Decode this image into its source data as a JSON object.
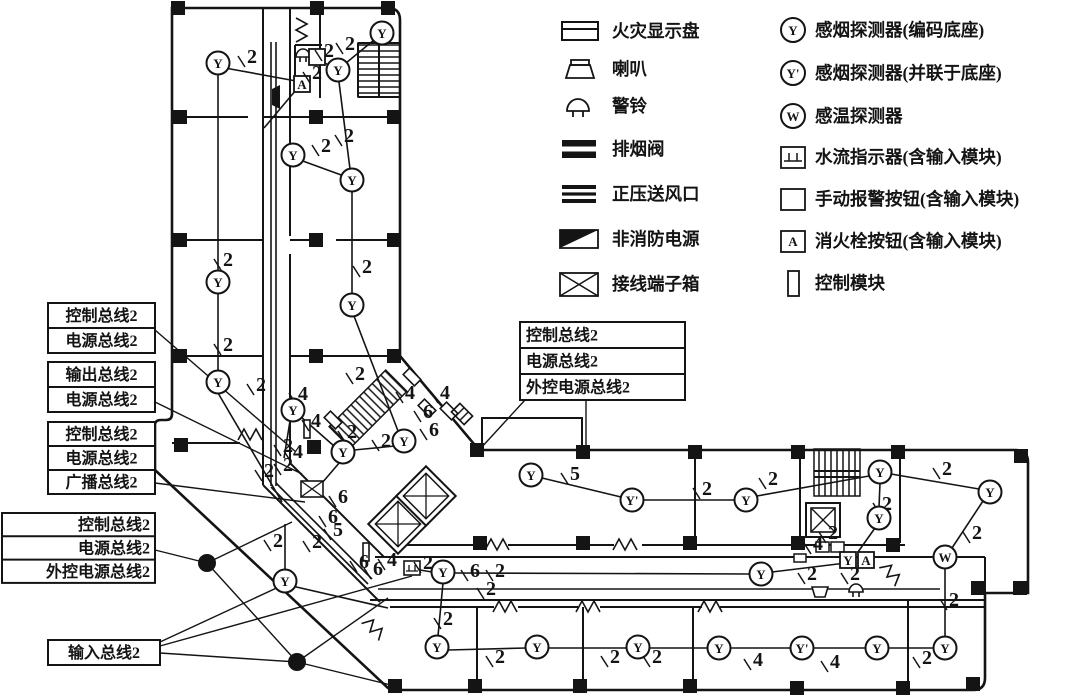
{
  "colors": {
    "ink": "#141414",
    "bg": "#ffffff"
  },
  "legend": {
    "left": [
      {
        "icon": "fire-display-panel-icon",
        "label": "火灾显示盘"
      },
      {
        "icon": "speaker-icon",
        "label": "喇叭"
      },
      {
        "icon": "alarm-bell-icon",
        "label": "警铃"
      },
      {
        "icon": "smoke-exhaust-valve-icon",
        "label": "排烟阀"
      },
      {
        "icon": "pressurized-air-outlet-icon",
        "label": "正压送风口"
      },
      {
        "icon": "non-fire-power-icon",
        "label": "非消防电源"
      },
      {
        "icon": "terminal-box-icon",
        "label": "接线端子箱"
      }
    ],
    "right": [
      {
        "icon": "smoke-detector-icon",
        "symbol": "Y",
        "label": "感烟探测器(编码底座)"
      },
      {
        "icon": "smoke-detector-parallel-icon",
        "symbol": "Y'",
        "label": "感烟探测器(并联于底座)"
      },
      {
        "icon": "heat-detector-icon",
        "symbol": "W",
        "label": "感温探测器"
      },
      {
        "icon": "water-flow-indicator-icon",
        "symbol": "",
        "label": "水流指示器(含输入模块)"
      },
      {
        "icon": "manual-alarm-button-icon",
        "symbol": "",
        "label": "手动报警按钮(含输入模块)"
      },
      {
        "icon": "hydrant-button-icon",
        "symbol": "A",
        "label": "消火栓按钮(含输入模块)"
      },
      {
        "icon": "control-module-icon",
        "symbol": "",
        "label": "控制模块"
      }
    ]
  },
  "callouts": {
    "left_groups": [
      {
        "x": 48,
        "y": 303,
        "w": 107,
        "rh": 25,
        "align": "middle",
        "rows": [
          "控制总线2",
          "电源总线2"
        ]
      },
      {
        "x": 48,
        "y": 362,
        "w": 107,
        "rh": 25,
        "align": "middle",
        "rows": [
          "输出总线2",
          "电源总线2"
        ]
      },
      {
        "x": 48,
        "y": 422,
        "w": 107,
        "rh": 24,
        "align": "middle",
        "rows": [
          "控制总线2",
          "电源总线2",
          "广播总线2"
        ]
      },
      {
        "x": 2,
        "y": 513,
        "w": 153,
        "rh": 23.3,
        "align": "end",
        "rows": [
          "控制总线2",
          "电源总线2",
          "外控电源总线2"
        ]
      },
      {
        "x": 48,
        "y": 640,
        "w": 112,
        "rh": 25,
        "align": "middle",
        "rows": [
          "输入总线2"
        ]
      }
    ],
    "middle_box": {
      "x": 520,
      "y": 322,
      "w": 165,
      "rh": 26,
      "align": "start",
      "rows": [
        "控制总线2",
        "电源总线2",
        "外控电源总线2"
      ]
    }
  },
  "plan": {
    "detectors": [
      {
        "t": "Y",
        "x": 218,
        "y": 63
      },
      {
        "t": "Y",
        "x": 338,
        "y": 70
      },
      {
        "t": "Y",
        "x": 382,
        "y": 33
      },
      {
        "t": "Y",
        "x": 293,
        "y": 155
      },
      {
        "t": "Y",
        "x": 352,
        "y": 180
      },
      {
        "t": "Y",
        "x": 218,
        "y": 282
      },
      {
        "t": "Y",
        "x": 218,
        "y": 382
      },
      {
        "t": "Y",
        "x": 352,
        "y": 305
      },
      {
        "t": "Y",
        "x": 293,
        "y": 410
      },
      {
        "t": "Y",
        "x": 343,
        "y": 452
      },
      {
        "t": "Y",
        "x": 404,
        "y": 441
      },
      {
        "t": "Y",
        "x": 285,
        "y": 581
      },
      {
        "t": "Y",
        "x": 443,
        "y": 572
      },
      {
        "t": "Y",
        "x": 761,
        "y": 574
      },
      {
        "t": "Y",
        "x": 437,
        "y": 647
      },
      {
        "t": "Y",
        "x": 537,
        "y": 647
      },
      {
        "t": "Y",
        "x": 638,
        "y": 647
      },
      {
        "t": "Y",
        "x": 719,
        "y": 648
      },
      {
        "t": "Y'",
        "x": 802,
        "y": 648
      },
      {
        "t": "Y",
        "x": 877,
        "y": 648
      },
      {
        "t": "Y",
        "x": 945,
        "y": 648
      },
      {
        "t": "Y",
        "x": 531,
        "y": 475
      },
      {
        "t": "Y'",
        "x": 632,
        "y": 500
      },
      {
        "t": "Y",
        "x": 746,
        "y": 500
      },
      {
        "t": "Y",
        "x": 880,
        "y": 472
      },
      {
        "t": "Y",
        "x": 879,
        "y": 518
      },
      {
        "t": "Y",
        "x": 990,
        "y": 492
      },
      {
        "t": "W",
        "x": 945,
        "y": 557
      }
    ],
    "wire_labels": [
      {
        "n": "2",
        "x": 252,
        "y": 57
      },
      {
        "n": "2",
        "x": 329,
        "y": 51
      },
      {
        "n": "2",
        "x": 350,
        "y": 44
      },
      {
        "n": "2",
        "x": 317,
        "y": 73
      },
      {
        "n": "2",
        "x": 326,
        "y": 146
      },
      {
        "n": "2",
        "x": 349,
        "y": 136
      },
      {
        "n": "2",
        "x": 228,
        "y": 260
      },
      {
        "n": "2",
        "x": 367,
        "y": 267
      },
      {
        "n": "2",
        "x": 228,
        "y": 345
      },
      {
        "n": "2",
        "x": 360,
        "y": 374
      },
      {
        "n": "2",
        "x": 261,
        "y": 385
      },
      {
        "n": "4",
        "x": 303,
        "y": 394
      },
      {
        "n": "4",
        "x": 316,
        "y": 421
      },
      {
        "n": "2",
        "x": 288,
        "y": 446
      },
      {
        "n": "4",
        "x": 298,
        "y": 452
      },
      {
        "n": "2",
        "x": 288,
        "y": 465
      },
      {
        "n": "2",
        "x": 269,
        "y": 471
      },
      {
        "n": "2",
        "x": 352,
        "y": 432
      },
      {
        "n": "2",
        "x": 386,
        "y": 441
      },
      {
        "n": "4",
        "x": 410,
        "y": 393
      },
      {
        "n": "4",
        "x": 445,
        "y": 393
      },
      {
        "n": "6",
        "x": 428,
        "y": 412
      },
      {
        "n": "6",
        "x": 434,
        "y": 430
      },
      {
        "n": "6",
        "x": 343,
        "y": 497
      },
      {
        "n": "6",
        "x": 333,
        "y": 517
      },
      {
        "n": "5",
        "x": 338,
        "y": 530
      },
      {
        "n": "2",
        "x": 278,
        "y": 541
      },
      {
        "n": "2",
        "x": 317,
        "y": 542
      },
      {
        "n": "6",
        "x": 364,
        "y": 562
      },
      {
        "n": "6",
        "x": 378,
        "y": 569
      },
      {
        "n": "4",
        "x": 392,
        "y": 560
      },
      {
        "n": "2",
        "x": 428,
        "y": 563
      },
      {
        "n": "6",
        "x": 475,
        "y": 571
      },
      {
        "n": "2",
        "x": 500,
        "y": 571
      },
      {
        "n": "2",
        "x": 491,
        "y": 589
      },
      {
        "n": "2",
        "x": 448,
        "y": 619
      },
      {
        "n": "5",
        "x": 575,
        "y": 474
      },
      {
        "n": "2",
        "x": 707,
        "y": 489
      },
      {
        "n": "2",
        "x": 773,
        "y": 479
      },
      {
        "n": "2",
        "x": 947,
        "y": 469
      },
      {
        "n": "2",
        "x": 887,
        "y": 504
      },
      {
        "n": "2",
        "x": 977,
        "y": 533
      },
      {
        "n": "2",
        "x": 954,
        "y": 600
      },
      {
        "n": "4",
        "x": 818,
        "y": 544
      },
      {
        "n": "2",
        "x": 833,
        "y": 533
      },
      {
        "n": "2",
        "x": 812,
        "y": 574
      },
      {
        "n": "2",
        "x": 855,
        "y": 574
      },
      {
        "n": "2",
        "x": 500,
        "y": 657
      },
      {
        "n": "2",
        "x": 615,
        "y": 657
      },
      {
        "n": "2",
        "x": 657,
        "y": 657
      },
      {
        "n": "4",
        "x": 758,
        "y": 660
      },
      {
        "n": "4",
        "x": 835,
        "y": 662
      },
      {
        "n": "2",
        "x": 927,
        "y": 658
      }
    ],
    "edges": [
      [
        225,
        68,
        296,
        81
      ],
      [
        218,
        74,
        218,
        271
      ],
      [
        218,
        293,
        218,
        371
      ],
      [
        218,
        393,
        282,
        502
      ],
      [
        374,
        40,
        346,
        63
      ],
      [
        330,
        66,
        320,
        60
      ],
      [
        296,
        90,
        264,
        128
      ],
      [
        300,
        160,
        344,
        176
      ],
      [
        350,
        169,
        339,
        82
      ],
      [
        352,
        191,
        352,
        294
      ],
      [
        354,
        316,
        398,
        431
      ],
      [
        395,
        446,
        354,
        450
      ],
      [
        334,
        446,
        301,
        417
      ],
      [
        290,
        421,
        284,
        458
      ],
      [
        340,
        462,
        322,
        483
      ],
      [
        285,
        570,
        285,
        524
      ],
      [
        292,
        586,
        388,
        608
      ],
      [
        271,
        42,
        271,
        486
      ],
      [
        276,
        42,
        276,
        486
      ],
      [
        271,
        487,
        368,
        584
      ],
      [
        276,
        483,
        372,
        579
      ],
      [
        420,
        570,
        432,
        572
      ],
      [
        454,
        573,
        750,
        574
      ],
      [
        772,
        572,
        846,
        563
      ],
      [
        378,
        589,
        940,
        589
      ],
      [
        443,
        583,
        438,
        636
      ],
      [
        448,
        650,
        526,
        648
      ],
      [
        548,
        648,
        627,
        648
      ],
      [
        649,
        648,
        708,
        648
      ],
      [
        730,
        648,
        791,
        648
      ],
      [
        813,
        648,
        866,
        648
      ],
      [
        888,
        648,
        934,
        648
      ],
      [
        542,
        478,
        621,
        497
      ],
      [
        643,
        500,
        735,
        500
      ],
      [
        757,
        496,
        869,
        476
      ],
      [
        891,
        474,
        979,
        489
      ],
      [
        880,
        483,
        879,
        507
      ],
      [
        875,
        528,
        858,
        552
      ],
      [
        983,
        501,
        952,
        548
      ],
      [
        945,
        568,
        945,
        637
      ]
    ],
    "leaders": [
      [
        155,
        330,
        296,
        452
      ],
      [
        155,
        402,
        302,
        474
      ],
      [
        155,
        483,
        305,
        502
      ],
      [
        155,
        550,
        207,
        563
      ],
      [
        207,
        563,
        292,
        522
      ],
      [
        207,
        563,
        297,
        662
      ],
      [
        160,
        642,
        283,
        585
      ],
      [
        160,
        646,
        412,
        576
      ],
      [
        160,
        653,
        297,
        662
      ],
      [
        297,
        662,
        388,
        598
      ],
      [
        297,
        662,
        395,
        686
      ],
      [
        525,
        400,
        480,
        449
      ],
      [
        586,
        400,
        586,
        450
      ]
    ],
    "columns": [
      [
        178,
        8
      ],
      [
        317,
        8
      ],
      [
        388,
        8
      ],
      [
        180,
        117
      ],
      [
        316,
        117
      ],
      [
        394,
        117
      ],
      [
        180,
        240
      ],
      [
        316,
        240
      ],
      [
        394,
        240
      ],
      [
        180,
        356
      ],
      [
        316,
        356
      ],
      [
        394,
        356
      ],
      [
        181,
        445
      ],
      [
        314,
        447
      ],
      [
        477,
        450
      ],
      [
        583,
        452
      ],
      [
        695,
        452
      ],
      [
        798,
        452
      ],
      [
        898,
        452
      ],
      [
        1021,
        456
      ],
      [
        480,
        543
      ],
      [
        583,
        543
      ],
      [
        690,
        543
      ],
      [
        798,
        543
      ],
      [
        893,
        545
      ],
      [
        978,
        588
      ],
      [
        1020,
        588
      ],
      [
        395,
        686
      ],
      [
        475,
        686
      ],
      [
        580,
        686
      ],
      [
        690,
        686
      ],
      [
        797,
        688
      ],
      [
        903,
        688
      ],
      [
        973,
        684
      ]
    ],
    "dots": [
      [
        207,
        563
      ],
      [
        297,
        662
      ]
    ],
    "devices": [
      {
        "k": "bell",
        "x": 303,
        "y": 52
      },
      {
        "k": "sq",
        "x": 317,
        "y": 57,
        "s": ""
      },
      {
        "k": "sq",
        "x": 302,
        "y": 84,
        "s": "A"
      },
      {
        "k": "spkL",
        "x": 276,
        "y": 97
      },
      {
        "k": "wf",
        "x": 412,
        "y": 568
      },
      {
        "k": "fdp",
        "x": 830,
        "y": 547
      },
      {
        "k": "sq",
        "x": 848,
        "y": 560,
        "s": "Y"
      },
      {
        "k": "sq",
        "x": 866,
        "y": 560,
        "s": "A"
      },
      {
        "k": "rect",
        "x": 800,
        "y": 558
      },
      {
        "k": "xbox",
        "x": 312,
        "y": 489
      },
      {
        "k": "bar",
        "x": 307,
        "y": 429
      },
      {
        "k": "bar",
        "x": 366,
        "y": 552
      },
      {
        "k": "rot",
        "x": 412,
        "y": 377
      },
      {
        "k": "rot",
        "x": 427,
        "y": 408
      },
      {
        "k": "rot",
        "x": 449,
        "y": 411
      },
      {
        "k": "rot",
        "x": 333,
        "y": 420
      },
      {
        "k": "rotH",
        "x": 462,
        "y": 414
      },
      {
        "k": "spkD",
        "x": 820,
        "y": 592
      },
      {
        "k": "bell",
        "x": 856,
        "y": 587
      }
    ],
    "doors": [
      {
        "x": 296,
        "y": 30,
        "r": 90
      },
      {
        "x": 250,
        "y": 440,
        "r": 0
      },
      {
        "x": 497,
        "y": 550,
        "r": 0
      },
      {
        "x": 625,
        "y": 550,
        "r": 0
      },
      {
        "x": 887,
        "y": 577,
        "r": 50
      },
      {
        "x": 370,
        "y": 632,
        "r": 45
      },
      {
        "x": 505,
        "y": 612,
        "r": 0
      },
      {
        "x": 588,
        "y": 612,
        "r": 0
      },
      {
        "x": 710,
        "y": 612,
        "r": 0
      }
    ]
  }
}
